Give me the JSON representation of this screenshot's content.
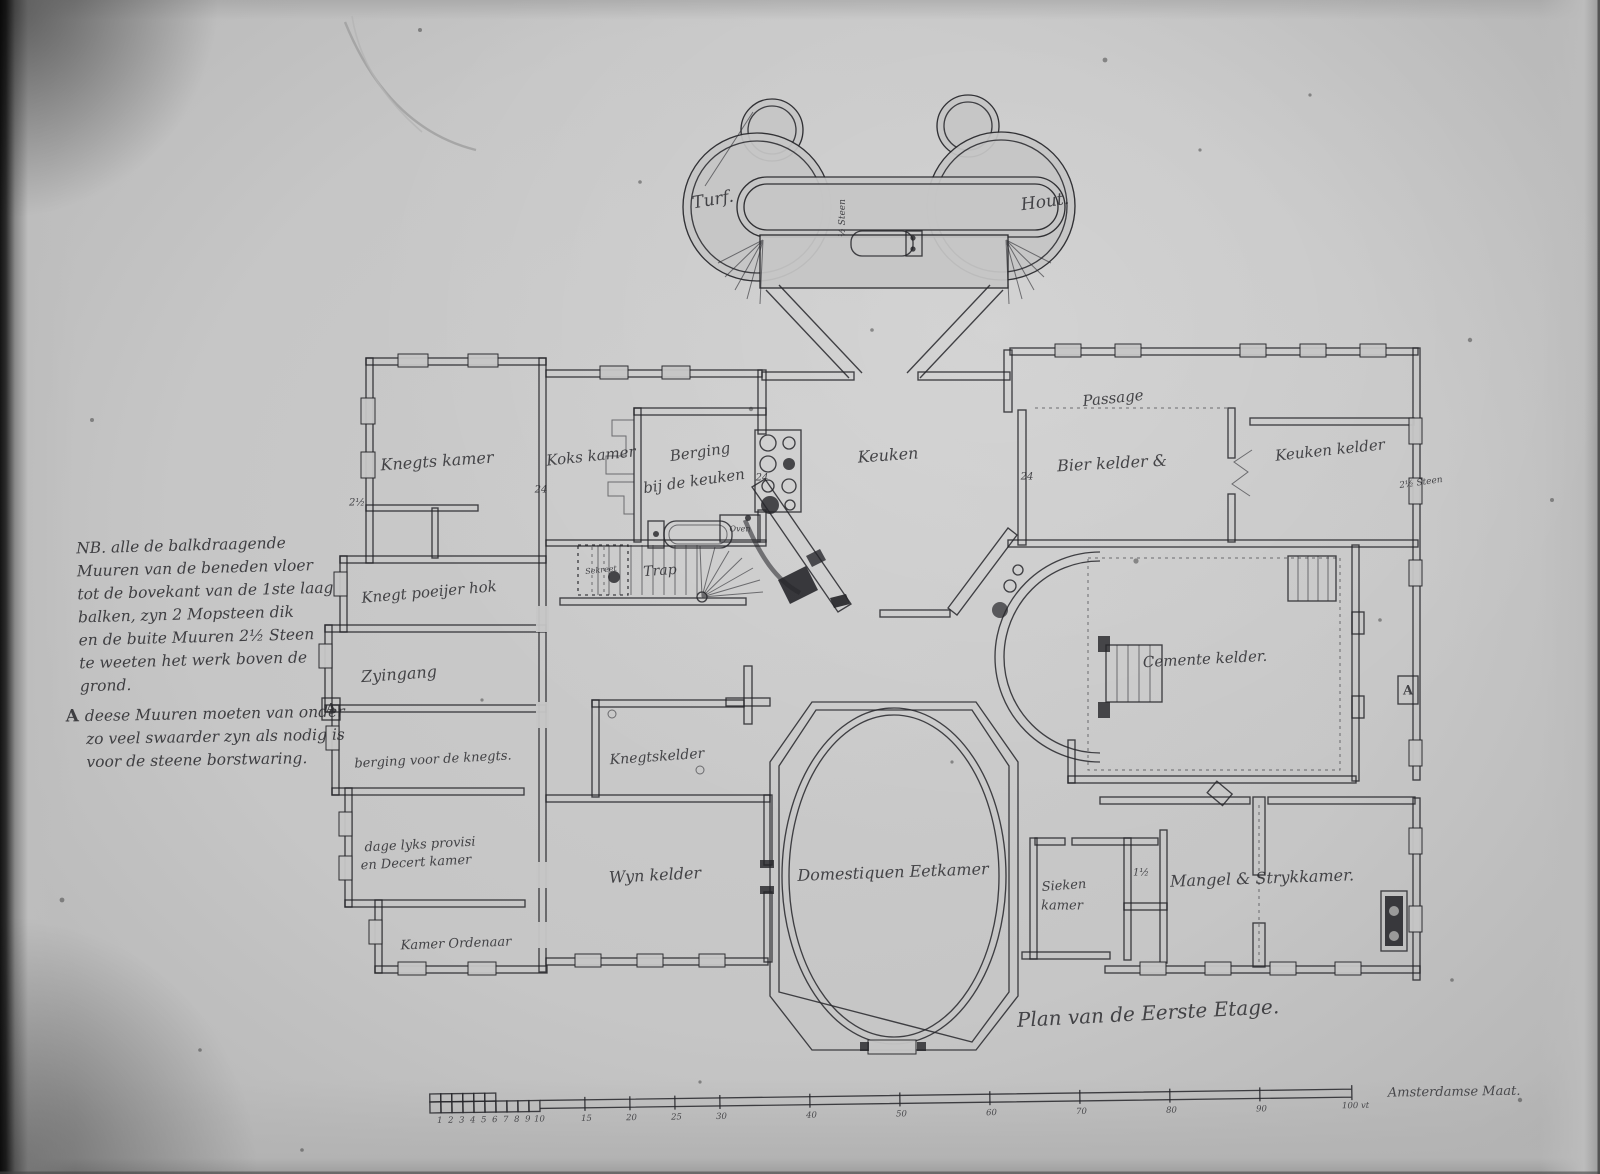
{
  "document": {
    "caption": "Plan van de Eerste Etage."
  },
  "annex": {
    "turf": "Turf.",
    "hout": "Hout.",
    "half_steen": "½ Steen"
  },
  "rooms": {
    "knegtskamer": "Knegts kamer",
    "kokskamer": "Koks kamer",
    "berging_keuken_1": "Berging",
    "berging_keuken_2": "bij de keuken",
    "keuken": "Keuken",
    "passage": "Passage",
    "bier_kelder": "Bier kelder &",
    "keuken_kelder": "Keuken kelder",
    "knegt_poeijer_hok": "Knegt poeijer hok",
    "zyingang": "Zyingang",
    "berging_knegts": "berging voor de knegts.",
    "sekreet": "Sekreet",
    "trap": "Trap",
    "oven": "Oven",
    "knegtskelder": "Knegtskelder",
    "dagelyks_1": "dage lyks provisi",
    "dagelyks_2": "en Decert kamer",
    "kamer_ordenaar": "Kamer Ordenaar",
    "wyn_kelder": "Wyn kelder",
    "domestiquen_eetkamer": "Domestiquen Eetkamer",
    "sieken_1": "Sieken",
    "sieken_2": "kamer",
    "mangel": "Mangel  &  Strykkamer.",
    "cemente_kelder": "Cemente kelder."
  },
  "wall_markers": {
    "m24_a": "24",
    "m24_b": "24",
    "m24_c": "24",
    "m2h_left": "2½",
    "m2h_right": "2½ Steen",
    "m1h": "1½",
    "a_left": "A",
    "a_right": "A"
  },
  "notes": {
    "main_lines": [
      "NB. alle de balkdraagende",
      "Muuren van de beneden vloer",
      "tot de bovekant van de 1ste laag",
      "balken, zyn 2 Mopsteen dik",
      "en de buite Muuren 2½ Steen",
      "te weeten het werk boven de",
      "grond."
    ],
    "a_marker": "A",
    "a_lines": [
      "deese Muuren moeten van onder",
      "zo veel swaarder zyn als nodig is",
      "voor de steene borstwaring."
    ]
  },
  "scale": {
    "unit_ticks": [
      "1",
      "2",
      "3",
      "4",
      "5",
      "6",
      "7",
      "8",
      "9",
      "10"
    ],
    "major_ticks": [
      "15",
      "20",
      "25",
      "30",
      "40",
      "50",
      "60",
      "70",
      "80",
      "90"
    ],
    "end_label": "100 vt",
    "caption": "Amsterdamse Maat."
  },
  "colors": {
    "ink": "#26262a",
    "paper": "#c6c6c6"
  }
}
